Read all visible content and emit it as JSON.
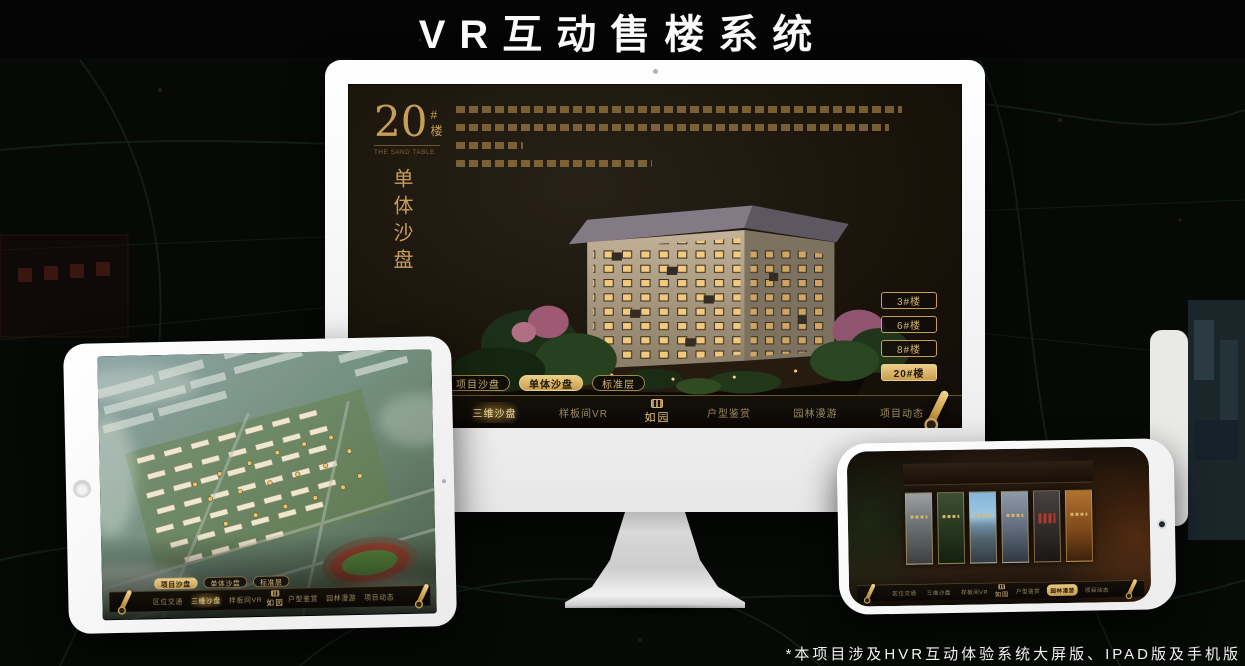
{
  "page": {
    "title": "VR互动售楼系统",
    "footnote": "*本项目涉及HVR互动体验系统大屏版、IPAD版及手机版"
  },
  "shared": {
    "sub_tabs": [
      "项目沙盘",
      "单体沙盘",
      "标准层"
    ],
    "nav_left": [
      "区位交通",
      "三维沙盘",
      "样板间VR"
    ],
    "nav_right": [
      "户型鉴赏",
      "园林漫游",
      "项目动态"
    ],
    "logo_text": "如园"
  },
  "monitor": {
    "hero": {
      "number": "20",
      "suffix": "#楼",
      "en": "THE SAND TABLE",
      "vertical": "单体沙盘"
    },
    "floor_buttons": [
      {
        "label": "3#楼",
        "active": false
      },
      {
        "label": "6#楼",
        "active": false
      },
      {
        "label": "8#楼",
        "active": false
      },
      {
        "label": "20#楼",
        "active": true
      }
    ],
    "active_sub_tab": "单体沙盘",
    "active_nav_item": "三维沙盘"
  },
  "tablet": {
    "active_sub_tab": "项目沙盘",
    "active_nav_item": "三维沙盘"
  },
  "phone": {
    "active_nav_item": "园林漫游",
    "gallery_panel_count": 6
  },
  "icons": {
    "scroll": "scroll-icon",
    "seal": "seal-icon",
    "camera": "camera-icon",
    "home": "home-button"
  },
  "colors": {
    "gold": "#d2a95e",
    "gold_bright": "#ecd194",
    "gold_fill": "#d8b36a",
    "screen_bg": "#17120c",
    "page_bg": "#060906",
    "text_white": "#f2f2f2"
  }
}
